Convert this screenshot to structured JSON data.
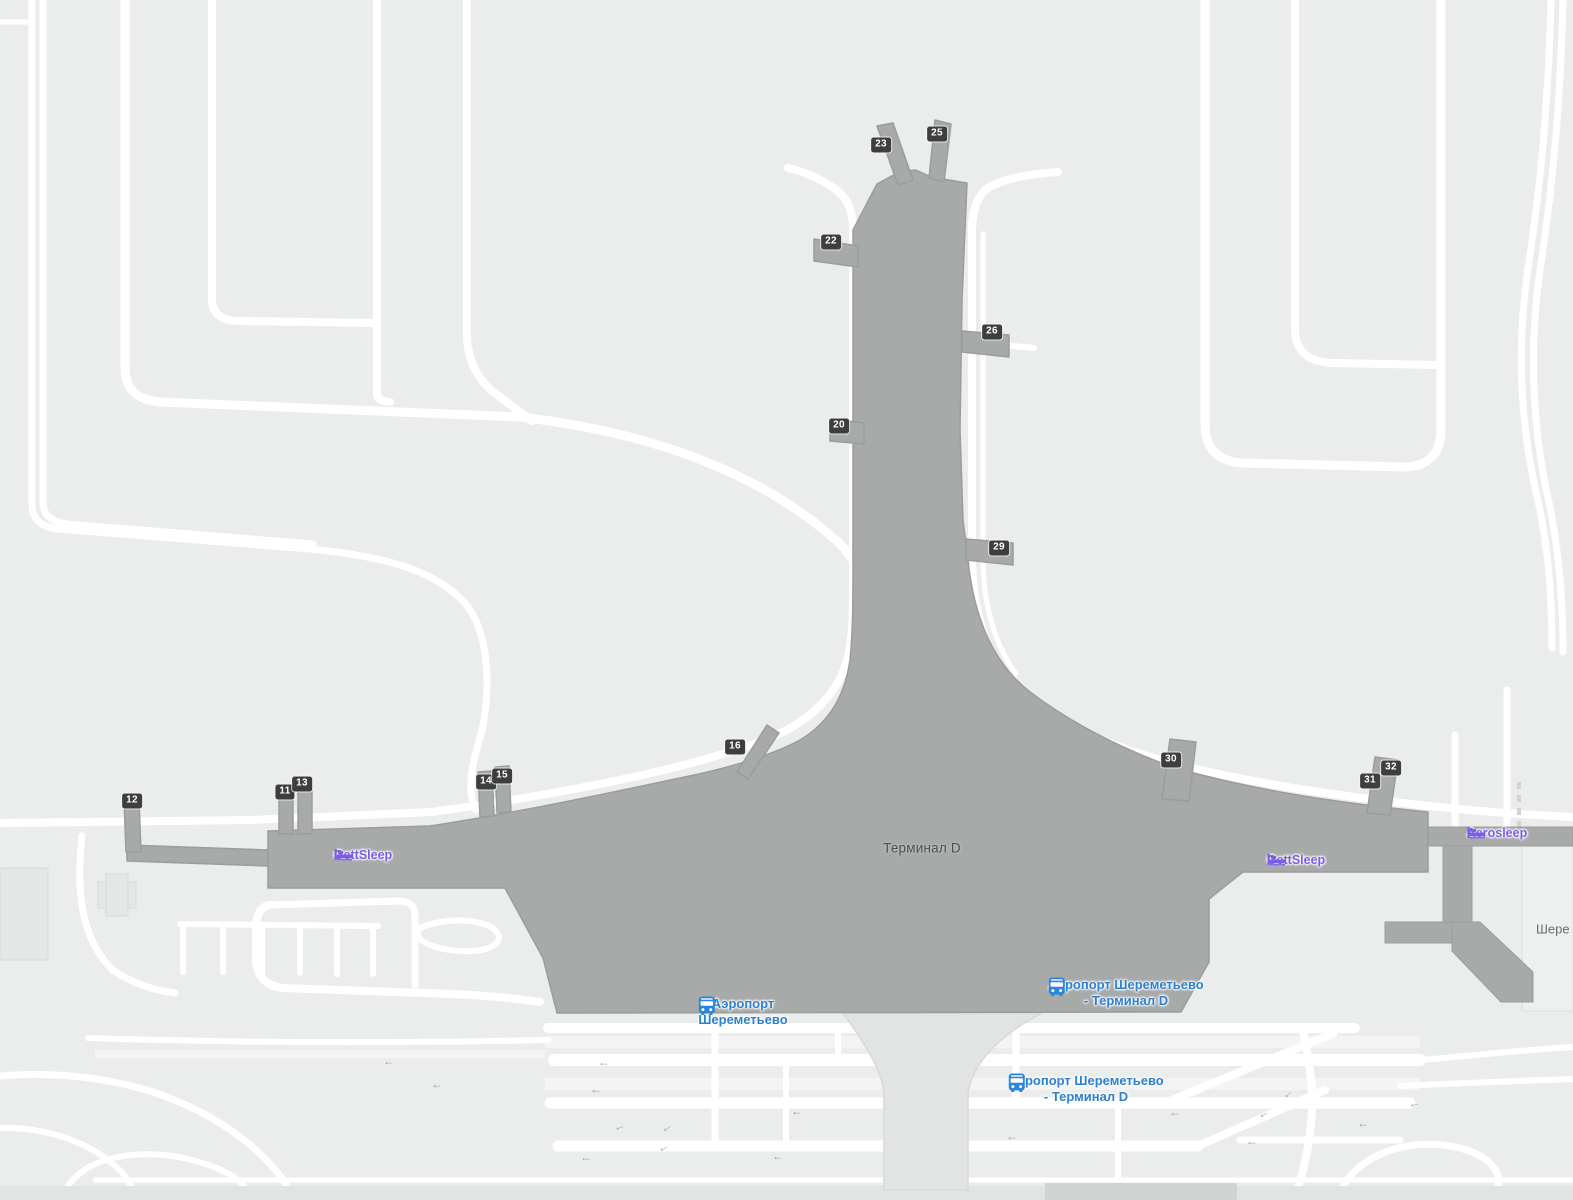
{
  "colors": {
    "background": "#ebedec",
    "road": "#ffffff",
    "terminal_fill": "#a8aaa9",
    "terminal_stroke": "#9a9d9c",
    "hotel_accent": "#7b5ce8",
    "transit_accent": "#2e80d0",
    "badge_bg": "#3d3e3e",
    "badge_text": "#ffffff",
    "ramp_fill": "#e2e4e3",
    "arrow_gray": "#9da3a1"
  },
  "terminal": {
    "label": "Терминал D",
    "x": 922,
    "y": 848
  },
  "partial_label": {
    "text": "Шере",
    "x": 1536,
    "y": 929
  },
  "gates": [
    {
      "number": "12",
      "x": 132,
      "y": 801
    },
    {
      "number": "11",
      "x": 285,
      "y": 792
    },
    {
      "number": "13",
      "x": 302,
      "y": 784
    },
    {
      "number": "14",
      "x": 486,
      "y": 782
    },
    {
      "number": "15",
      "x": 502,
      "y": 776
    },
    {
      "number": "16",
      "x": 735,
      "y": 747
    },
    {
      "number": "20",
      "x": 839,
      "y": 426
    },
    {
      "number": "22",
      "x": 831,
      "y": 242
    },
    {
      "number": "23",
      "x": 881,
      "y": 145
    },
    {
      "number": "25",
      "x": 937,
      "y": 134
    },
    {
      "number": "26",
      "x": 992,
      "y": 332
    },
    {
      "number": "29",
      "x": 999,
      "y": 548
    },
    {
      "number": "30",
      "x": 1171,
      "y": 760
    },
    {
      "number": "31",
      "x": 1370,
      "y": 781
    },
    {
      "number": "32",
      "x": 1391,
      "y": 768
    }
  ],
  "hotels": [
    {
      "name": "GettSleep",
      "x": 363,
      "y": 848,
      "icon": "bed-icon"
    },
    {
      "name": "GettSleep",
      "x": 1296,
      "y": 853,
      "icon": "bed-icon"
    },
    {
      "name": "Aerosleep",
      "x": 1497,
      "y": 826,
      "icon": "bed-icon"
    }
  ],
  "transit_stops": [
    {
      "line1": "Аэропорт",
      "line2": "Шереметьево",
      "x": 743,
      "y": 996,
      "icon": "bus-icon"
    },
    {
      "line1": "Аэропорт Шереметьево",
      "line2": "- Терминал D",
      "x": 1126,
      "y": 977,
      "icon": "bus-icon"
    },
    {
      "line1": "Аэропорт Шереметьево",
      "line2": "- Терминал D",
      "x": 1086,
      "y": 1073,
      "icon": "bus-icon"
    }
  ],
  "arrows": [
    {
      "x": 389,
      "y": 1061,
      "rot": 0
    },
    {
      "x": 437,
      "y": 1084,
      "rot": 0
    },
    {
      "x": 604,
      "y": 1062,
      "rot": 0
    },
    {
      "x": 596,
      "y": 1089,
      "rot": 0
    },
    {
      "x": 619,
      "y": 1126,
      "rot": -20
    },
    {
      "x": 666,
      "y": 1127,
      "rot": -35
    },
    {
      "x": 797,
      "y": 1111,
      "rot": 0
    },
    {
      "x": 586,
      "y": 1157,
      "rot": 0
    },
    {
      "x": 663,
      "y": 1147,
      "rot": -25
    },
    {
      "x": 778,
      "y": 1156,
      "rot": 0
    },
    {
      "x": 1012,
      "y": 1136,
      "rot": 0
    },
    {
      "x": 1175,
      "y": 1112,
      "rot": 0
    },
    {
      "x": 1252,
      "y": 1141,
      "rot": 0
    },
    {
      "x": 1263,
      "y": 1113,
      "rot": -30
    },
    {
      "x": 1287,
      "y": 1093,
      "rot": -40
    },
    {
      "x": 1363,
      "y": 1123,
      "rot": 0
    },
    {
      "x": 1414,
      "y": 1103,
      "rot": -15
    }
  ]
}
